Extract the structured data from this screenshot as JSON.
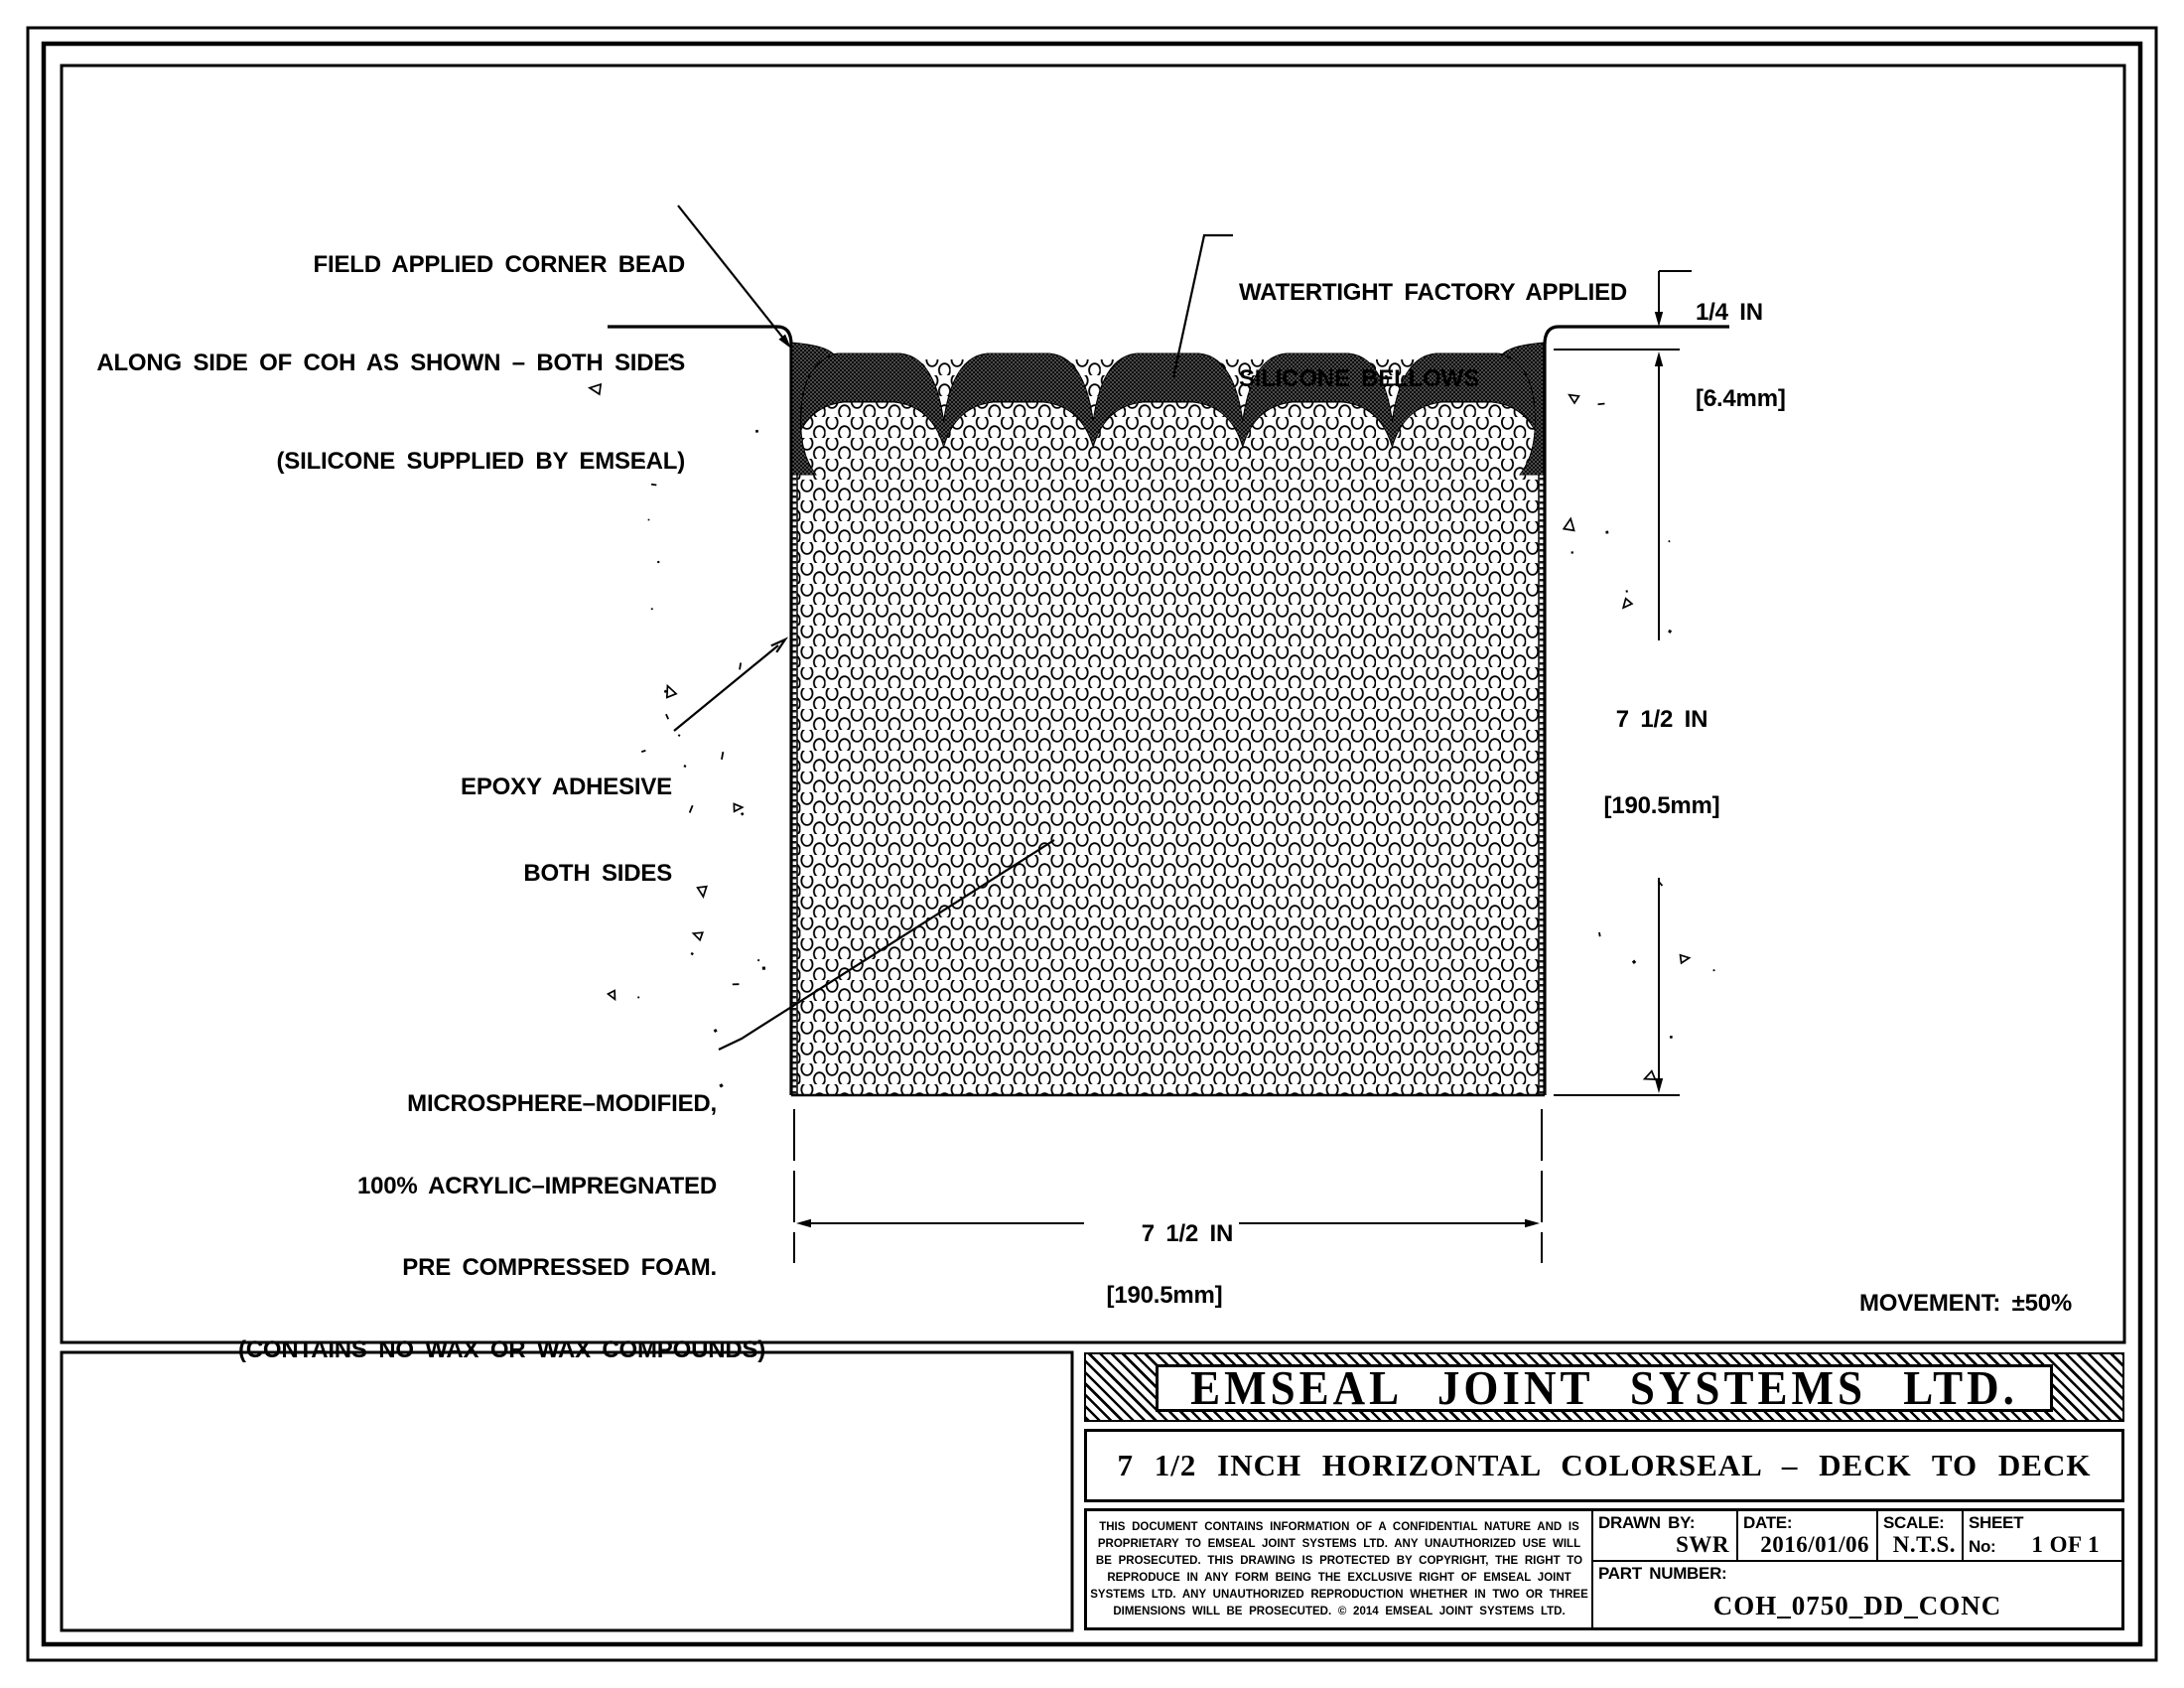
{
  "colors": {
    "ink": "#000000",
    "paper": "#ffffff"
  },
  "annotations": {
    "corner_bead": {
      "lines": [
        "FIELD APPLIED CORNER BEAD",
        "ALONG SIDE OF COH AS SHOWN – BOTH SIDES",
        "(SILICONE SUPPLIED BY EMSEAL)"
      ]
    },
    "bellows": {
      "lines": [
        "WATERTIGHT FACTORY APPLIED",
        "SILICONE BELLOWS"
      ]
    },
    "epoxy": {
      "lines": [
        "EPOXY ADHESIVE",
        "BOTH SIDES"
      ]
    },
    "foam": {
      "lines": [
        "MICROSPHERE–MODIFIED,",
        "100% ACRYLIC–IMPREGNATED",
        "PRE COMPRESSED FOAM.",
        "(CONTAINS NO WAX OR WAX COMPOUNDS)"
      ]
    }
  },
  "dimensions": {
    "recess": {
      "in": "1/4 IN",
      "mm": "[6.4mm]"
    },
    "depth": {
      "in": "7 1/2 IN",
      "mm": "[190.5mm]"
    },
    "width": {
      "in": "7 1/2 IN",
      "mm": "[190.5mm]"
    }
  },
  "movement": {
    "lines": [
      "MOVEMENT: ±50%",
      "+ 3 3/4 IN (95mm)",
      "− 3 3/4 IN (95mm)"
    ]
  },
  "title_block": {
    "company": "EMSEAL JOINT SYSTEMS LTD.",
    "drawing_title": "7 1/2 INCH HORIZONTAL COLORSEAL – DECK TO DECK",
    "legal_lines": [
      "THIS DOCUMENT CONTAINS INFORMATION OF A CONFIDENTIAL NATURE AND IS",
      "PROPRIETARY TO EMSEAL JOINT SYSTEMS LTD. ANY UNAUTHORIZED USE WILL",
      "BE PROSECUTED. THIS DRAWING IS PROTECTED BY COPYRIGHT, THE RIGHT TO",
      "REPRODUCE IN ANY FORM BEING THE EXCLUSIVE RIGHT OF EMSEAL JOINT",
      "SYSTEMS LTD. ANY UNAUTHORIZED REPRODUCTION WHETHER IN TWO OR THREE",
      "DIMENSIONS WILL BE PROSECUTED. © 2014 EMSEAL JOINT SYSTEMS LTD."
    ],
    "drawn_by_label": "DRAWN BY:",
    "drawn_by": "SWR",
    "date_label": "DATE:",
    "date": "2016/01/06",
    "scale_label": "SCALE:",
    "scale": "N.T.S.",
    "sheet_label": "SHEET",
    "sheet_no_label": "No:",
    "sheet_no": "1 OF 1",
    "part_number_label": "PART NUMBER:",
    "part_number": "COH_0750_DD_CONC"
  }
}
